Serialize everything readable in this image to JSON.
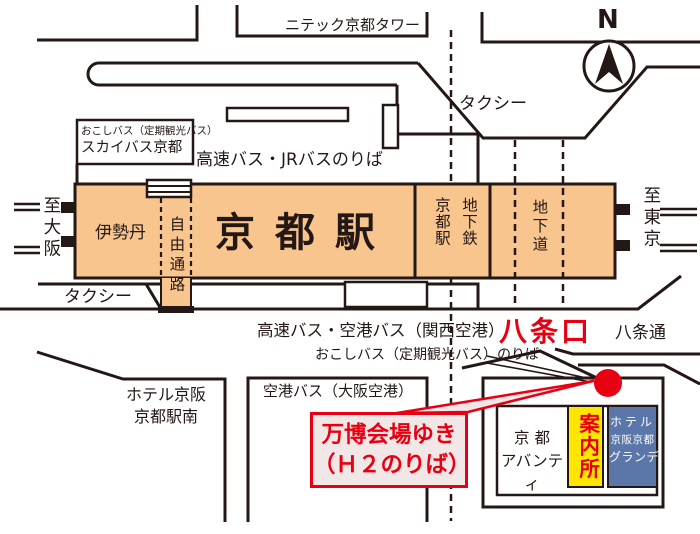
{
  "colors": {
    "ink": "#231815",
    "station_orange": "#F9C58E",
    "accent_red": "#E60012",
    "info_yellow": "#FFE600",
    "hotel_blue": "#5B76A8",
    "callout_fill": "#F2E7E7"
  },
  "labels": {
    "nidec_tower": "ニテック京都タワー",
    "north": "N",
    "taxi_top": "タクシー",
    "okoshi_sky_line1": "おこしバス（定期観光バス）",
    "okoshi_sky_line2": "スカイバス京都",
    "highway_jr_bus": "高速バス・JRバスのりば",
    "to_osaka": "至大阪",
    "isetan": "伊勢丹",
    "free_passage": "自由通路",
    "kyoto_station": "京都駅",
    "subway_kyoto_station": "地下鉄\n京都駅",
    "underground_passage": "地下道",
    "to_tokyo": "至東京",
    "taxi_south": "タクシー",
    "highway_airport_bus": "高速バス・空港バス（関西空港）",
    "okoshi_noriba": "おこしバス（定期観光バス）のりば",
    "hachijo_exit": "八条口",
    "hachijo_dori": "八条通",
    "hotel_keihan_south": "ホテル京阪\n京都駅南",
    "airport_bus_osaka": "空港バス（大阪空港）",
    "expo_shuttle": "万博会場ゆき\n（Ｈ２のりば）",
    "kyoto_avanti": "京 都\nアバンティ",
    "info_center": "案内所",
    "hotel_grande_line1": "ホテル",
    "hotel_grande_line2": "京阪京都",
    "hotel_grande_line3": "グランデ"
  }
}
